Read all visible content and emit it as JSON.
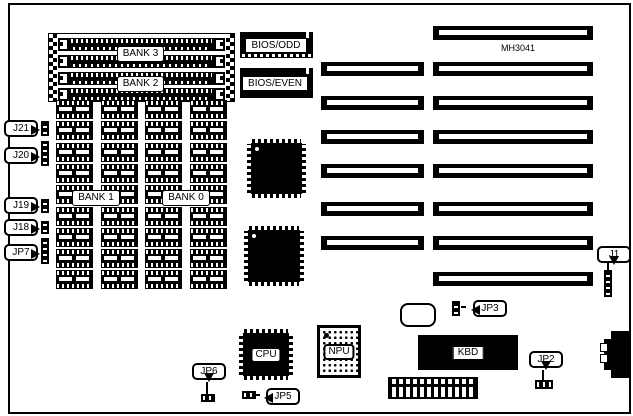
{
  "colors": {
    "ink": "#000000",
    "paper": "#ffffff"
  },
  "board": {
    "model_label": "MH3041"
  },
  "memory": {
    "bank3": "BANK 3",
    "bank2": "BANK 2",
    "bank1": "BANK 1",
    "bank0": "BANK 0",
    "grid": {
      "columns": 4,
      "rows": 9,
      "col_pitch": 44.7,
      "row_pitch": 21.3
    },
    "simm_row_offsets": [
      4,
      21,
      38,
      54
    ]
  },
  "chips": {
    "bios_odd": "BIOS/ODD",
    "bios_even": "BIOS/EVEN",
    "cpu": "CPU",
    "npu": "NPU",
    "kbd": "KBD"
  },
  "jumpers": {
    "j21": "J21",
    "j20": "J20",
    "j19": "J19",
    "j18": "J18",
    "jp7": "JP7",
    "jp6": "JP6",
    "jp5": "JP5",
    "jp3": "JP3",
    "jp2": "JP2",
    "j1": "J1"
  },
  "expansion_slots": {
    "segment_height": 14,
    "left_segment": {
      "x": 321,
      "width": 103
    },
    "right_segment": {
      "x": 433,
      "width": 160
    },
    "rows": [
      {
        "y": 26,
        "has_left": false
      },
      {
        "y": 62,
        "has_left": true
      },
      {
        "y": 96,
        "has_left": true
      },
      {
        "y": 130,
        "has_left": true
      },
      {
        "y": 164,
        "has_left": true
      },
      {
        "y": 202,
        "has_left": true
      },
      {
        "y": 236,
        "has_left": true
      },
      {
        "y": 272,
        "has_left": false
      }
    ]
  }
}
